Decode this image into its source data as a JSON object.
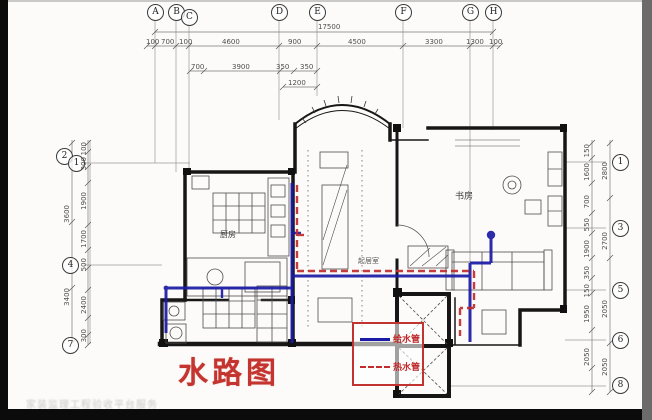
{
  "title_stamp": "水路图",
  "watermark": "家装监理工程验收平台服务",
  "colors": {
    "supply_pipe_blue": "#1a1aa6",
    "hot_pipe_red": "#c22b2b",
    "legend_border_red": "#c23230",
    "title_red": "#c43530",
    "wall_black": "#161616",
    "dim_gray": "#4e4e4e",
    "paper": "#fcfbf9"
  },
  "legend": {
    "items": [
      {
        "label": "给水管",
        "line_style": "solid",
        "color": "#1a1aa6"
      },
      {
        "label": "热水管",
        "line_style": "dashed",
        "color": "#c22b2b"
      }
    ]
  },
  "rooms": [
    {
      "label": "厨房"
    },
    {
      "label": "书房"
    },
    {
      "label": "起居室"
    }
  ],
  "grid": {
    "top": [
      "A",
      "B",
      "C",
      "D",
      "E",
      "F",
      "G",
      "H"
    ],
    "left": [
      "2",
      "1",
      "4",
      "7"
    ],
    "right": [
      "1",
      "3",
      "5",
      "6",
      "8"
    ]
  },
  "dims": {
    "top_total": "17500",
    "row1": [
      "100",
      "700",
      "100",
      "4600",
      "900",
      "4500",
      "3300",
      "1300",
      "100"
    ],
    "row2": [
      "700",
      "3900",
      "350",
      "350"
    ],
    "row3": "1200",
    "left_inner": [
      "100",
      "300",
      "1900",
      "1700",
      "500",
      "2400",
      "300"
    ],
    "left_outer": [
      "3600",
      "3400"
    ],
    "right_inner": [
      "150",
      "1600",
      "700",
      "550",
      "1900",
      "350",
      "150",
      "1950",
      "2050"
    ],
    "right_outer": [
      "2800",
      "2700",
      "2050",
      "2050"
    ]
  }
}
